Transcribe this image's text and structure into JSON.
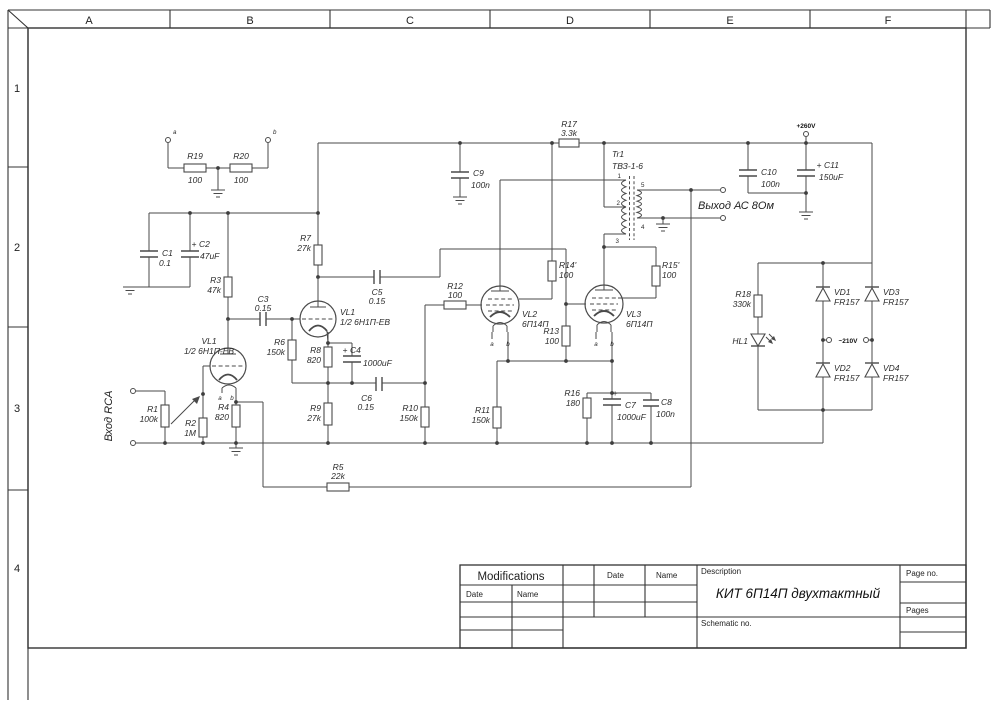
{
  "sheet": {
    "columns": [
      "A",
      "B",
      "C",
      "D",
      "E",
      "F"
    ],
    "rows": [
      "1",
      "2",
      "3",
      "4"
    ]
  },
  "labels": {
    "input": "Вход RCA",
    "output": "Выход АС 8Ом",
    "power": "+260V",
    "ac": "~210V",
    "pin_a": "a",
    "pin_b": "b",
    "term_a": "a",
    "term_b": "b"
  },
  "components": {
    "r1": {
      "label": "R1",
      "value": "100k"
    },
    "r2": {
      "label": "R2",
      "value": "1M"
    },
    "r3": {
      "label": "R3",
      "value": "47k"
    },
    "r4": {
      "label": "R4",
      "value": "820"
    },
    "r5": {
      "label": "R5",
      "value": "22k"
    },
    "r6": {
      "label": "R6",
      "value": "150k"
    },
    "r7": {
      "label": "R7",
      "value": "27k"
    },
    "r8": {
      "label": "R8",
      "value": "820"
    },
    "r9": {
      "label": "R9",
      "value": "27k"
    },
    "r10": {
      "label": "R10",
      "value": "150k"
    },
    "r11": {
      "label": "R11",
      "value": "150k"
    },
    "r12": {
      "label": "R12",
      "value": "100"
    },
    "r13": {
      "label": "R13",
      "value": "100"
    },
    "r14": {
      "label": "R14'",
      "value": "100"
    },
    "r15": {
      "label": "R15'",
      "value": "100"
    },
    "r16": {
      "label": "R16",
      "value": "180"
    },
    "r17": {
      "label": "R17",
      "value": "3.3k"
    },
    "r18": {
      "label": "R18",
      "value": "330k"
    },
    "r19": {
      "label": "R19",
      "value": "100"
    },
    "r20": {
      "label": "R20",
      "value": "100"
    },
    "c1": {
      "label": "C1",
      "value": "0.1"
    },
    "c2": {
      "label": "C2",
      "value": "47uF",
      "plus": "+"
    },
    "c3": {
      "label": "C3",
      "value": "0.15"
    },
    "c4": {
      "label": "C4",
      "value": "1000uF",
      "plus": "+"
    },
    "c5": {
      "label": "C5",
      "value": "0.15"
    },
    "c6": {
      "label": "C6",
      "value": "0.15"
    },
    "c7": {
      "label": "C7",
      "value": "1000uF",
      "plus": "+"
    },
    "c8": {
      "label": "C8",
      "value": "100n"
    },
    "c9": {
      "label": "C9",
      "value": "100n"
    },
    "c10": {
      "label": "C10",
      "value": "100n"
    },
    "c11": {
      "label": "C11",
      "value": "150uF",
      "plus": "+"
    },
    "vl1a": {
      "label": "VL1",
      "type": "1/2 6Н1П-ЕВ"
    },
    "vl1b": {
      "label": "VL1",
      "type": "1/2 6Н1П-ЕВ"
    },
    "vl2": {
      "label": "VL2",
      "type": "6П14П"
    },
    "vl3": {
      "label": "VL3",
      "type": "6П14П"
    },
    "tr1": {
      "label": "Tr1",
      "type": "ТВЗ-1-6",
      "taps": {
        "t1": "1",
        "t2": "2",
        "t3": "3",
        "t4": "4",
        "t5": "5"
      }
    },
    "vd1": {
      "label": "VD1",
      "value": "FR157"
    },
    "vd2": {
      "label": "VD2",
      "value": "FR157"
    },
    "vd3": {
      "label": "VD3",
      "value": "FR157"
    },
    "vd4": {
      "label": "VD4",
      "value": "FR157"
    },
    "hl1": {
      "label": "HL1"
    }
  },
  "title_block": {
    "modifications": "Modifications",
    "date": "Date",
    "name": "Name",
    "date2": "Date",
    "name2": "Name",
    "description_label": "Description",
    "description": "КИТ 6П14П двухтактный",
    "schematic_no": "Schematic no.",
    "page_no": "Page no.",
    "pages": "Pages"
  }
}
